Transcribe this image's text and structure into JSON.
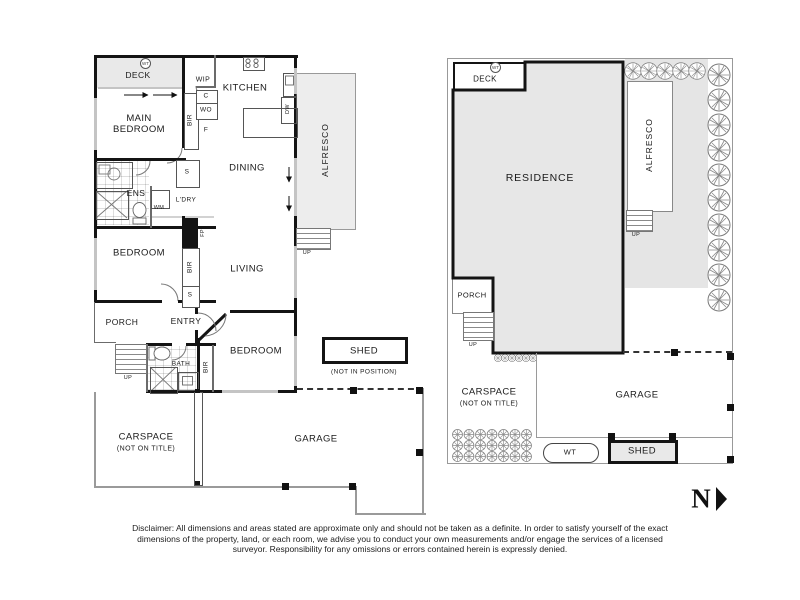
{
  "left_plan": {
    "deck": "DECK",
    "deck_wt": "WT",
    "main_bedroom": "MAIN BEDROOM",
    "wip": "WIP",
    "kitchen": "KITCHEN",
    "cupboard": "C",
    "wall_oven": "WO",
    "fridge": "F",
    "bir": "BIR",
    "dw": "DW",
    "dining": "DINING",
    "ens": "ENS",
    "wm": "WM",
    "laundry": "L'DRY",
    "store": "S",
    "fp": "FP",
    "living": "LIVING",
    "bedroom_mid": "BEDROOM",
    "porch": "PORCH",
    "entry": "ENTRY",
    "bath": "BATH",
    "bedroom_lower": "BEDROOM",
    "up": "UP",
    "alfresco": "ALFRESCO",
    "shed": "SHED",
    "shed_note": "(NOT IN POSITION)",
    "carspace": "CARSPACE",
    "carspace_note": "(NOT ON TITLE)",
    "garage": "GARAGE"
  },
  "right_plan": {
    "deck": "DECK",
    "deck_wt": "WT",
    "residence": "RESIDENCE",
    "alfresco": "ALFRESCO",
    "porch": "PORCH",
    "up": "UP",
    "carspace": "CARSPACE",
    "carspace_note": "(NOT ON TITLE)",
    "garage": "GARAGE",
    "water_tank": "WT",
    "shed": "SHED"
  },
  "north_label": "N",
  "disclaimer": "Disclaimer: All dimensions and areas stated are approximate only and should not be taken as a definite. In order to satisfy yourself of the exact dimensions of the property, land, or each room, we advise you to conduct your own measurements and/or engage the services of a licensed surveyor. Responsibility for any omissions or errors contained herein is expressly denied."
}
